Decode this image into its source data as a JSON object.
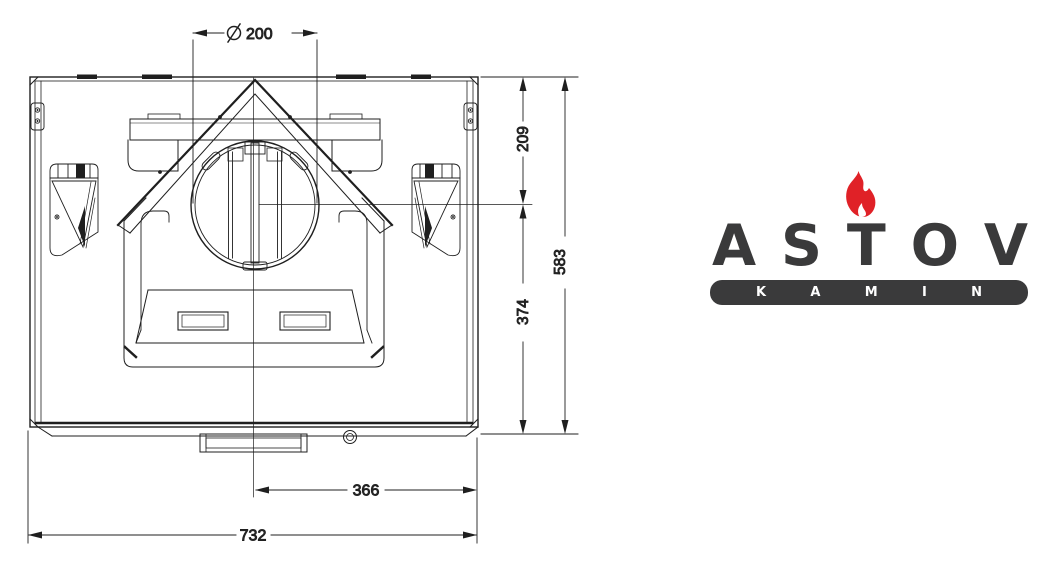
{
  "page": {
    "background": "#ffffff"
  },
  "drawing": {
    "type": "technical-drawing",
    "view": "fireplace insert top view",
    "dimensions": {
      "flue_diameter_symbol": "⌀",
      "flue_diameter": "200",
      "rear_to_flue_center": "209",
      "total_depth": "583",
      "flue_center_to_front": "374",
      "center_to_side": "366",
      "total_width": "732"
    }
  },
  "logo": {
    "brand": "ASTOV",
    "brand_letters": [
      "A",
      "S",
      "T",
      "O",
      "V"
    ],
    "subtitle": "KAMIN",
    "subtitle_letters": [
      "K",
      "A",
      "M",
      "I",
      "N"
    ],
    "colors": {
      "text": "#3a3a3b",
      "flame": "#e02127",
      "badge": "#3a3a3b",
      "badge_text": "#ffffff",
      "line": "#1f1f1f"
    }
  }
}
